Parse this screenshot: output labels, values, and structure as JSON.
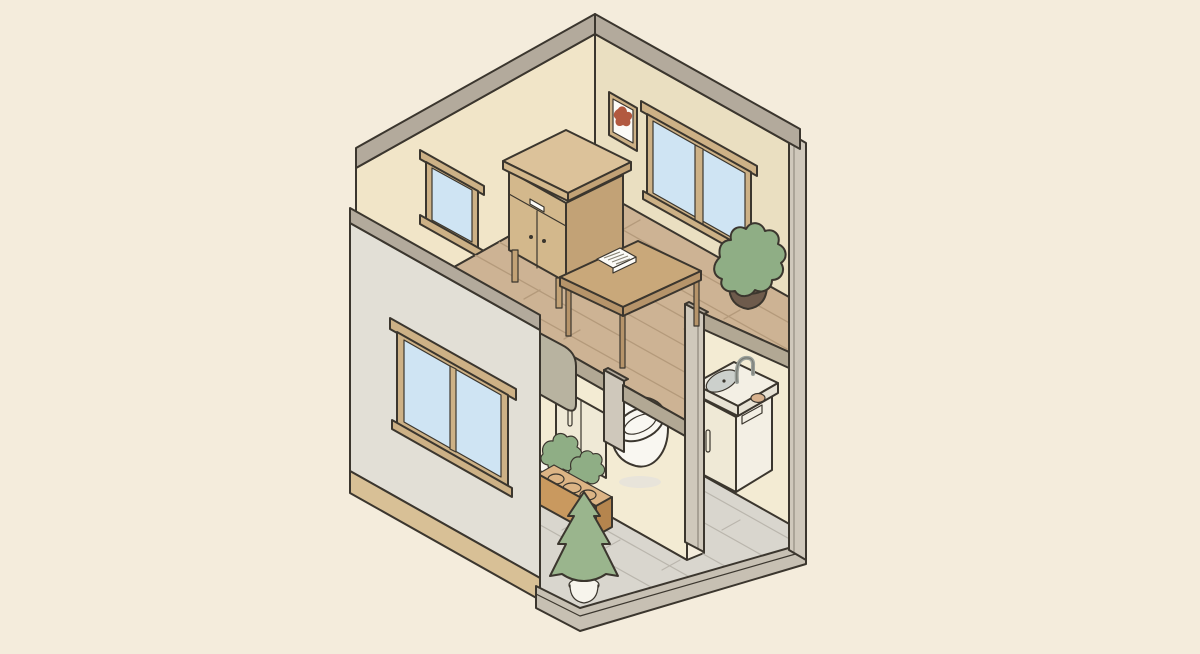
{
  "title": "Isometric cutaway illustration of a two-story tiny house with a living room above and a bathroom below",
  "palette": {
    "bg": "#f4ecdc",
    "outline": "#3b362e",
    "wallCapGray": "#b3aa9c",
    "wallCreamLeft": "#f1e5c8",
    "wallCreamRight": "#eadfc1",
    "wallCreamLower": "#f3ebd3",
    "wallGrayFace": "#e2dfd6",
    "skirtTan": "#d8c096",
    "slabGray": "#c7c0b3",
    "columnGreige": "#cfc8bb",
    "slabEdge": "#b2a894",
    "woodFloor": "#cdb394",
    "woodLine": "#b49a7b",
    "tileFloor": "#d9d6ce",
    "tileLine": "#bab6ad",
    "glassBlue": "#cfe4f3",
    "frameTan": "#cdb186",
    "tableWood": "#c9a87a",
    "tableWoodDark": "#b6946a",
    "dresserWood": "#d3b88c",
    "dresserSide": "#c2a276",
    "dresserTop": "#dcc29a",
    "sofaCushion": "#d9d0b4",
    "sofaArm": "#b8b3a0",
    "plantGreen": "#8fae85",
    "treeGreen": "#9ab58d",
    "potBrown": "#6e5b4c",
    "potWhite": "#f7f4ec",
    "planterFront": "#c9995f",
    "planterSide": "#b5854e",
    "planterFill": "#dcb485",
    "toiletWhite": "#f9f7f1",
    "toiletShade": "#e8e4da",
    "sinkWhite": "#f3efe4",
    "sinkCream": "#efe9d6",
    "sinkEdge": "#e7e2d4",
    "basinGray": "#ccd0cc",
    "faucetGray": "#9aa09a",
    "soapTan": "#d8b28e",
    "artRed": "#b2593f",
    "paperWhite": "#fcfbf7"
  },
  "scene": {
    "upper_floor": {
      "label": "living room",
      "objects": [
        "small-window",
        "large-double-window",
        "picture-frame",
        "sideboard",
        "coffee-table",
        "notebook",
        "sofa",
        "potted-plant",
        "wood-plank-floor"
      ]
    },
    "lower_floor": {
      "label": "bathroom",
      "objects": [
        "toilet",
        "sink-unit",
        "faucet",
        "soap-dish",
        "storage-cabinet",
        "planter-box",
        "shrubs",
        "cone-tree",
        "white-pot",
        "double-window",
        "tile-floor"
      ]
    }
  }
}
